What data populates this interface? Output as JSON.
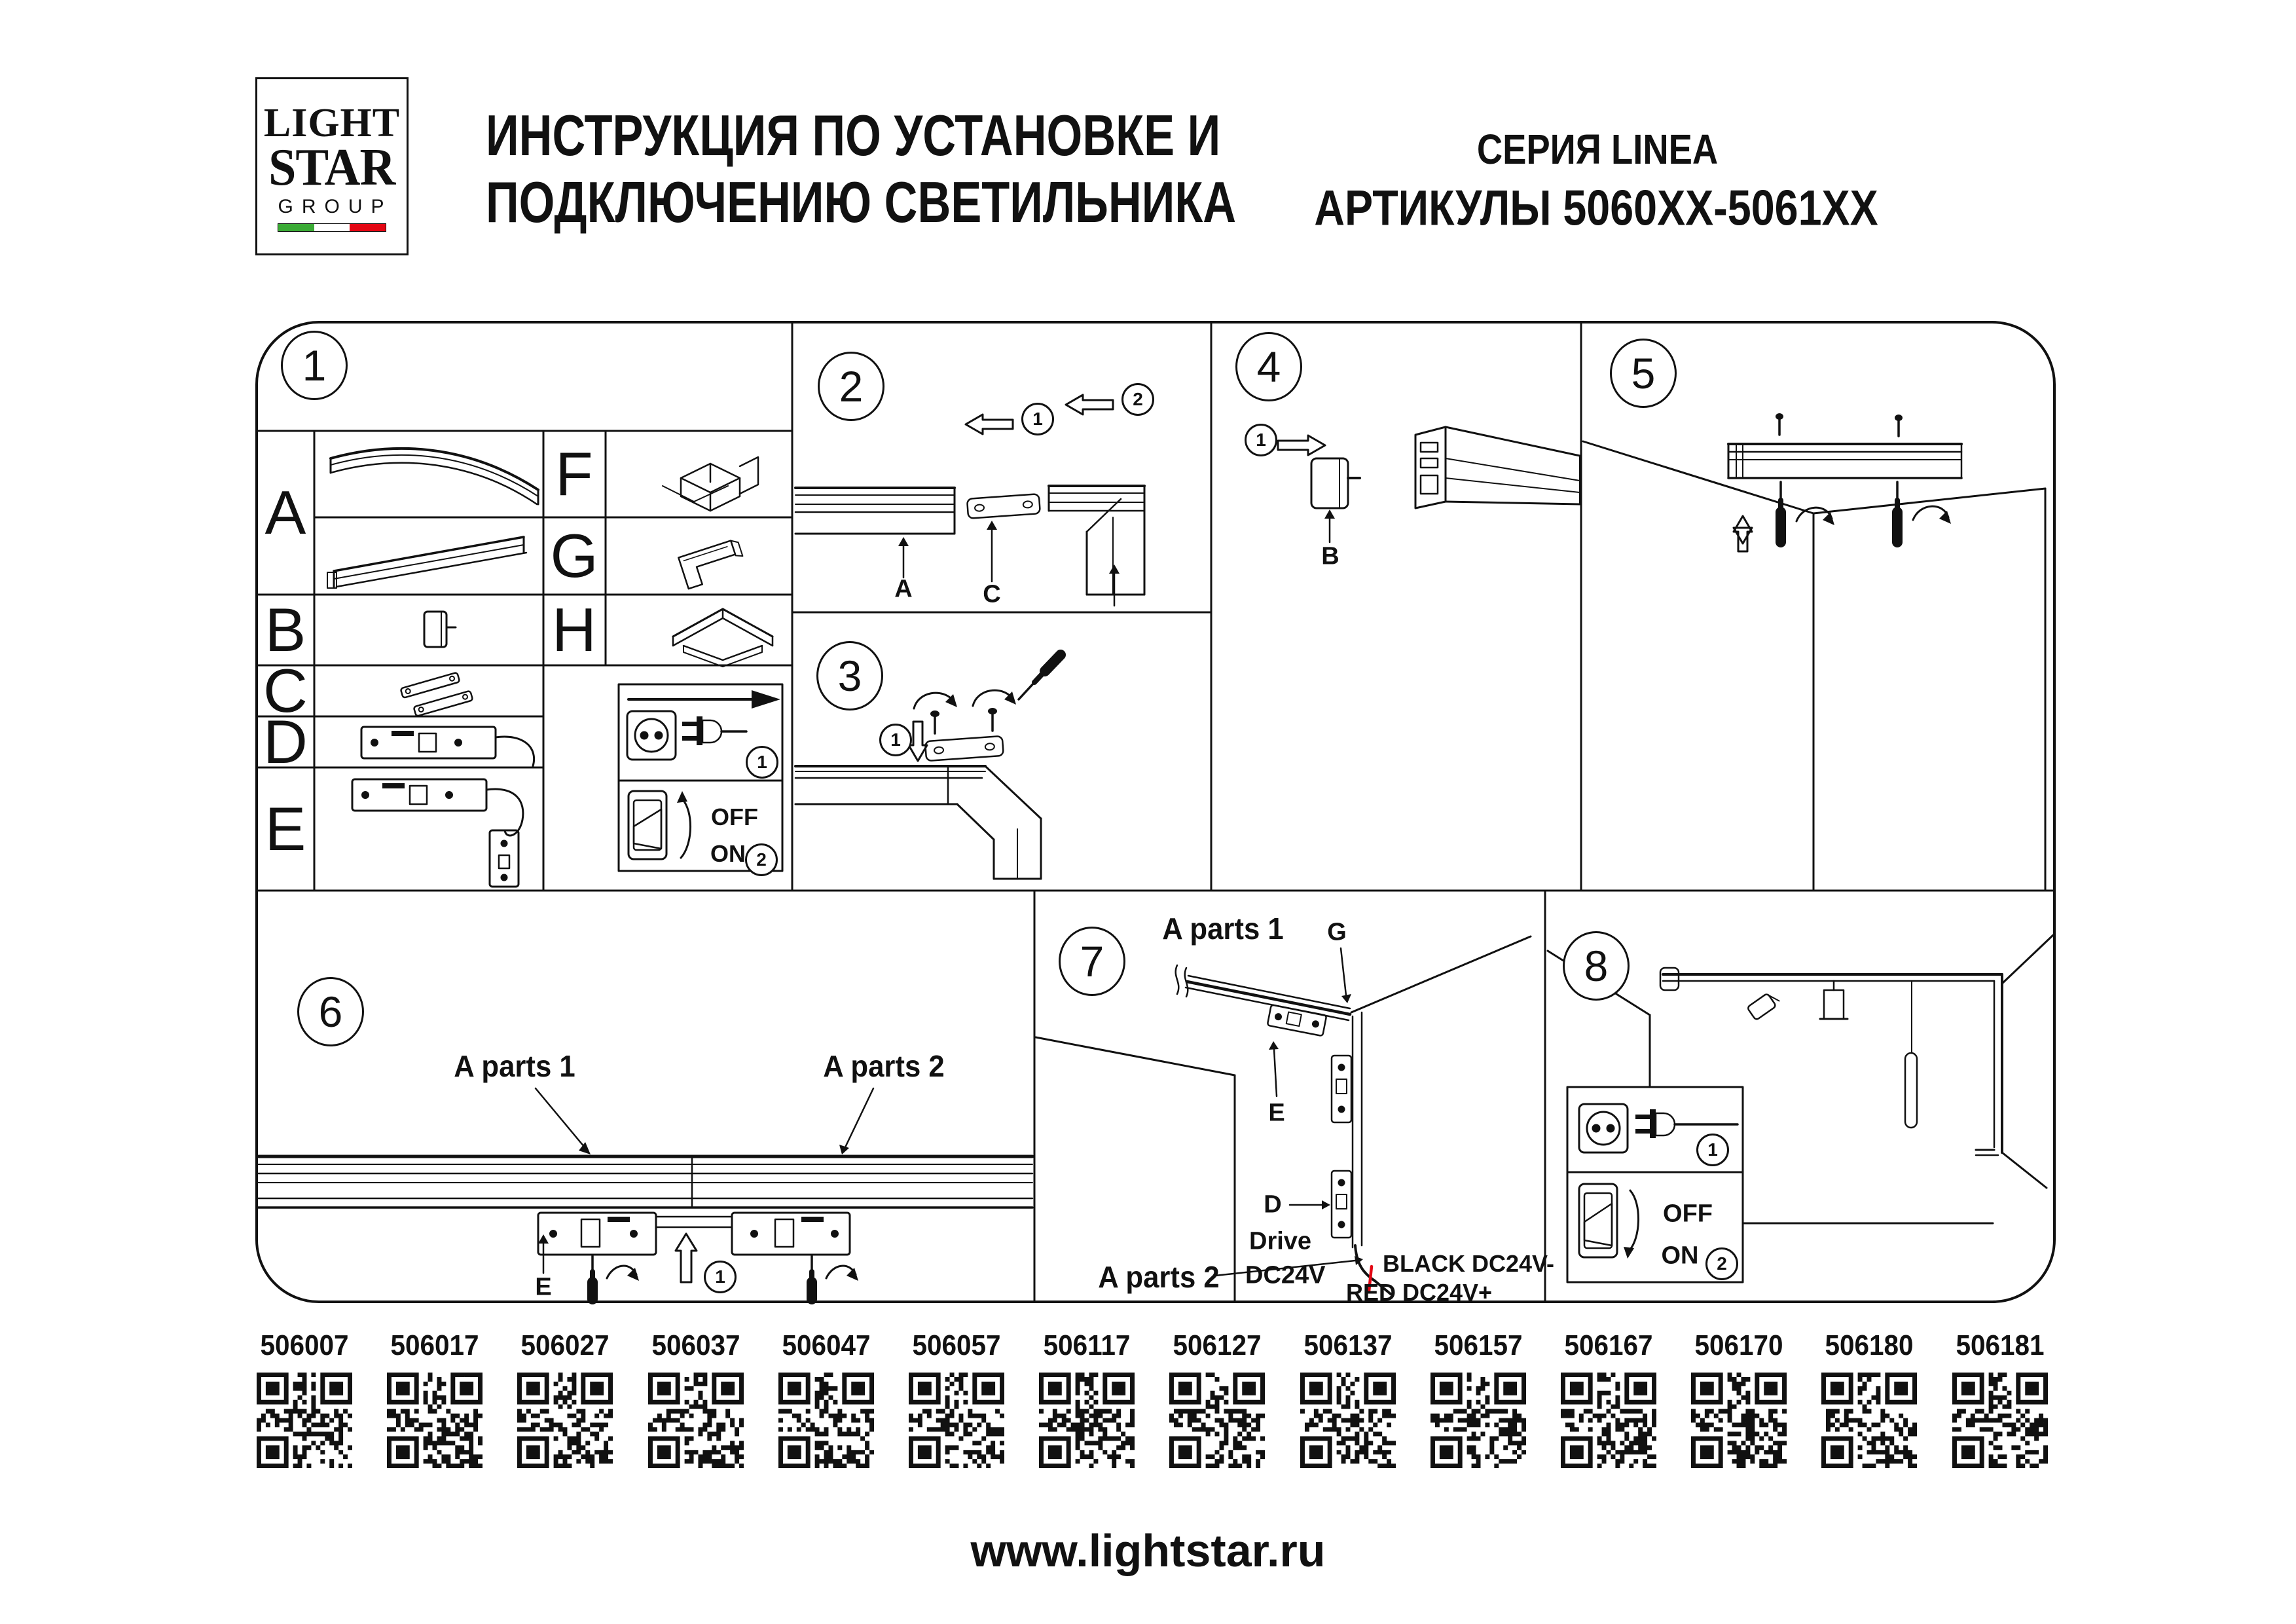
{
  "document": {
    "logo": {
      "line1": "LIGHT",
      "line2": "STAR",
      "line3": "GROUP"
    },
    "title_line1": "ИНСТРУКЦИЯ ПО УСТАНОВКЕ И",
    "title_line2": "ПОДКЛЮЧЕНИЮ СВЕТИЛЬНИКА",
    "series": "СЕРИЯ LINEA",
    "articles": "АРТИКУЛЫ 5060XX-5061XX",
    "website": "www.lightstar.ru"
  },
  "colors": {
    "ink": "#111111",
    "flag_green": "#3aaa35",
    "flag_red": "#e30613",
    "wire_red": "#e30613"
  },
  "panel1": {
    "number": "1",
    "part_labels_left": [
      "A",
      "B",
      "C",
      "D",
      "E"
    ],
    "part_labels_right": [
      "F",
      "G",
      "H"
    ],
    "steps": [
      "1",
      "2"
    ],
    "off_label": "OFF",
    "on_label": "ON"
  },
  "panel2": {
    "number": "2",
    "steps": [
      "1",
      "2"
    ],
    "label_a": "A",
    "label_c": "C"
  },
  "panel3": {
    "number": "3",
    "steps": [
      "1"
    ]
  },
  "panel4": {
    "number": "4",
    "steps": [
      "1"
    ],
    "label_b": "B"
  },
  "panel5": {
    "number": "5"
  },
  "panel6": {
    "number": "6",
    "label_a_parts1": "A parts 1",
    "label_a_parts2": "A parts 2",
    "label_e": "E",
    "steps": [
      "1"
    ]
  },
  "panel7": {
    "number": "7",
    "label_a_parts1": "A parts 1",
    "label_g": "G",
    "label_e": "E",
    "label_d": "D",
    "drive_line1": "Drive",
    "drive_line2": "DC24V",
    "wire_black": "BLACK DC24V-",
    "wire_red": "RED DC24V+",
    "label_a_parts2": "A parts 2"
  },
  "panel8": {
    "number": "8",
    "steps": [
      "1",
      "2"
    ],
    "off_label": "OFF",
    "on_label": "ON"
  },
  "qr_codes": [
    {
      "article": "506007"
    },
    {
      "article": "506017"
    },
    {
      "article": "506027"
    },
    {
      "article": "506037"
    },
    {
      "article": "506047"
    },
    {
      "article": "506057"
    },
    {
      "article": "506117"
    },
    {
      "article": "506127"
    },
    {
      "article": "506137"
    },
    {
      "article": "506157"
    },
    {
      "article": "506167"
    },
    {
      "article": "506170"
    },
    {
      "article": "506180"
    },
    {
      "article": "506181"
    }
  ]
}
